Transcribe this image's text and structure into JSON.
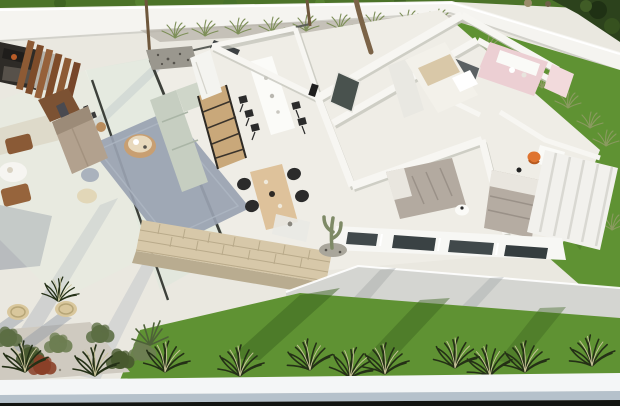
{
  "meta": {
    "image_type": "architectural-3d-render",
    "description": "Aerial 3D cutaway render of a modern single-storey villa: furnished living/kitchen/dining zone with glass walls and terrace on the left, bedroom wing with bathroom on the right, perimeter wall with planting, lawns and ornamental grass bed along the bottom edge",
    "visible_text": "none"
  },
  "scene": {
    "areas": [
      {
        "name": "outdoor-lounge",
        "detail": "dark sunken seating with orange cushion"
      },
      {
        "name": "pergola",
        "detail": "brown wooden slats"
      },
      {
        "name": "living-room",
        "detail": "blue-gray rug, sage sofa, taupe sofa, round wood coffee table, tv-cabinet, ladder shelf, poufs"
      },
      {
        "name": "kitchen-dining",
        "detail": "white island table with black stools, light-wood dining table with four black chairs"
      },
      {
        "name": "stone-feature-wall",
        "detail": "beige travertine cladding"
      },
      {
        "name": "bedroom-1",
        "detail": "white bed, wardrobe"
      },
      {
        "name": "bedroom-2",
        "detail": "gray bedding, round white nightstand"
      },
      {
        "name": "bedroom-3",
        "detail": "gray bedding, orange desk chair, striped wardrobe"
      },
      {
        "name": "bathroom",
        "detail": "pink walls, white vanity, dark shower glass"
      },
      {
        "name": "gardens",
        "detail": "lawn strips, olive grass tufts, cactus, wicker poufs, dark ornamental grasses"
      }
    ]
  },
  "colors": {
    "terrace": "#eae8e0",
    "floor": "#efede6",
    "lawn_top": "#4c7329",
    "foliage_dark": "#2c421c",
    "wall_white": "#f5f4f0",
    "wall_shade": "#d9d8d0",
    "grass": "#5f9233",
    "grass_shadow": "#3c6420",
    "gravel": "#b5b1a6",
    "walkway": "#d4d5d1",
    "shadow": "#98a1ae",
    "glass_tint": "#d9e6da",
    "frame_dark": "#3d403a",
    "pergola_wood": "#8d5a34",
    "lounge_dark": "#2e2b27",
    "rug": "#99a2b1",
    "sofa_sage": "#c6cec1",
    "sofa_taupe": "#b2a18e",
    "wood_light": "#dec29b",
    "wood_mid": "#c89f72",
    "wood_dark": "#7c5233",
    "chair_black": "#2b2b2b",
    "island_white": "#fbfbf8",
    "stone": "#d7c8a9",
    "stone_line": "#b4a585",
    "bed_white": "#f3f1ea",
    "bedding_gray": "#b3aaa0",
    "pillow": "#e9e6df",
    "bath_pink": "#eccfd3",
    "accent_orange": "#df7430",
    "window_glass": "#41494b",
    "trunk": "#6e573c",
    "plant_olive": "#7d8f58",
    "clump_dark": "#243016",
    "clump_light": "#c9c49a",
    "bush_green": "#5c6e44",
    "bush_red": "#8a4028",
    "pouf_wicker": "#d9c79c",
    "band_white": "#f4f6f7",
    "band_blue": "#b5c1cb",
    "band_dark": "#121411"
  }
}
